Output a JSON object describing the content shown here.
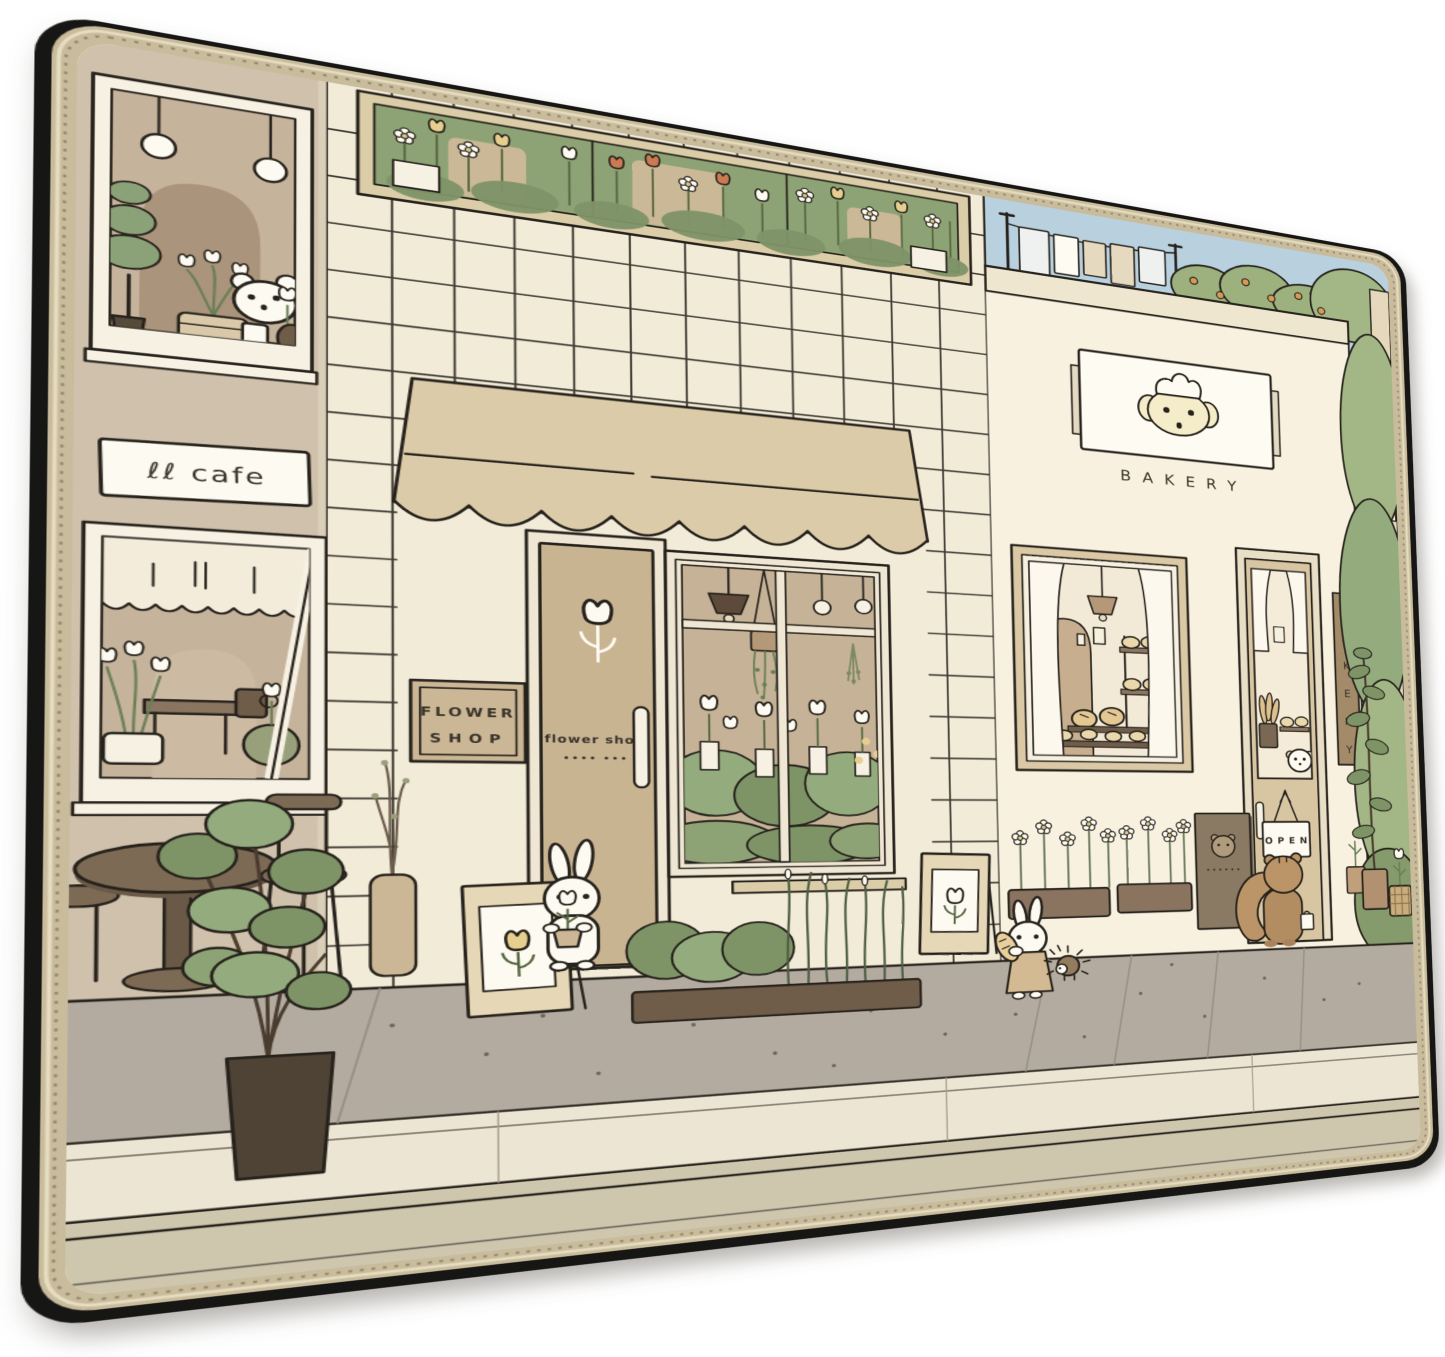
{
  "colors": {
    "mat_edge_black": "#161614",
    "mat_trim": "#c9bc9c",
    "base_cream": "#f2ebd8",
    "sky_blue": "#b9d0de",
    "cafe_wall_tan": "#cfc1ab",
    "window_glass_tan": "#c6b39c",
    "awning_tan": "#dbcba8",
    "door_tan": "#c9b492",
    "bakery_wall_cream": "#f8f1e0",
    "frame_white": "#f6f1e2",
    "green_dark": "#7e9467",
    "green_mid": "#93ab7d",
    "green_light": "#a3b685",
    "wood_brown": "#7d6a55",
    "pot_dark_brown": "#4f4336",
    "sidewalk_gray": "#b4aba0",
    "curb_cream": "#ece5d4",
    "street_khaki": "#cfc6ae",
    "outline_ink": "#26221c",
    "accent_orange": "#cb7a52",
    "accent_yellow": "#e6cf8e"
  },
  "cafe": {
    "sign_text": "ℓℓ cafe"
  },
  "flower_shop": {
    "plaque_line1": "FLOWER",
    "plaque_line2": "SHOP",
    "door_text": "flower shop",
    "door_dots": "•••• •••"
  },
  "bakery": {
    "sign_text": "B A K E R Y",
    "open_sign_text": "O P E N",
    "vertical_letters": [
      "B",
      "A",
      "K",
      "E",
      "R",
      "Y"
    ],
    "menu_board_dots": "••••••"
  }
}
